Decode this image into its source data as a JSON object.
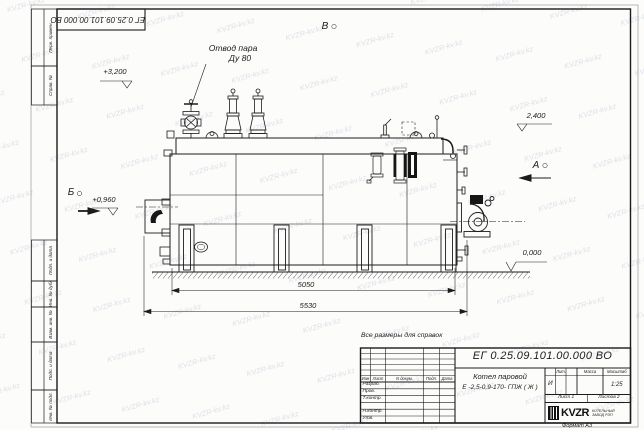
{
  "sheet": {
    "watermark": "KVZR-kv.kz",
    "format_label": "Формат А3",
    "note_reference": "Все размеры для справок"
  },
  "corner_stamp": {
    "doc_number_inverted": "ЕГ 0.25.09.101.00.000  ВО"
  },
  "margin_columns": {
    "perv_primen": "Перв. примен.",
    "sprav_no": "Справ. №",
    "podp_data_upper": "Подп. и дата",
    "inv_no_dubl": "Инв. № дубл.",
    "vzam_inv_no": "Взам. инв. №",
    "podp_data_lower": "Подп. и дата",
    "inv_no_podl": "Инв. № подл."
  },
  "annotations": {
    "steam_outlet_line1": "Отвод пара",
    "steam_outlet_line2": "Ду 80",
    "elevation_top": "+3,200",
    "elevation_drum": "2,400",
    "elevation_burner": "+0,960",
    "elevation_ground": "0,000",
    "view_marker_b": "Б",
    "view_marker_v": "В",
    "view_marker_a": "А",
    "dim_body_length": "5050",
    "dim_overall_length": "5530"
  },
  "title_block": {
    "doc_number": "ЕГ 0.25.09.101.00.000  ВО",
    "product_name_line1": "Котел паровой",
    "product_name_line2": "Е -2,5-0,9-170- ГПЖ ( Ж )",
    "col_izm": "Изм",
    "col_list": "Лист",
    "col_ndocum": "N докум.",
    "col_podp": "Подп.",
    "col_data": "Дата",
    "row_razrab": "Разраб.",
    "row_prov": "Пров.",
    "row_tkontr": "Т.контр.",
    "row_nkontr": "Н.контр.",
    "row_utv": "Утв.",
    "lit_header": "Лит.",
    "mass_header": "Масса",
    "scale_header": "Масштаб",
    "lit_value": "И",
    "scale_value": "1:25",
    "sheet_no": "Лист 1",
    "sheets_total": "Листов 2",
    "logo_text": "KVZR",
    "company_line1": "КОТЕЛЬНЫЙ",
    "company_line2": "ЗАВОД РЭП"
  },
  "colors": {
    "ink": "#1c1c1c",
    "watermark_tint": "#c9d2da",
    "paper": "#fcfcfb"
  }
}
